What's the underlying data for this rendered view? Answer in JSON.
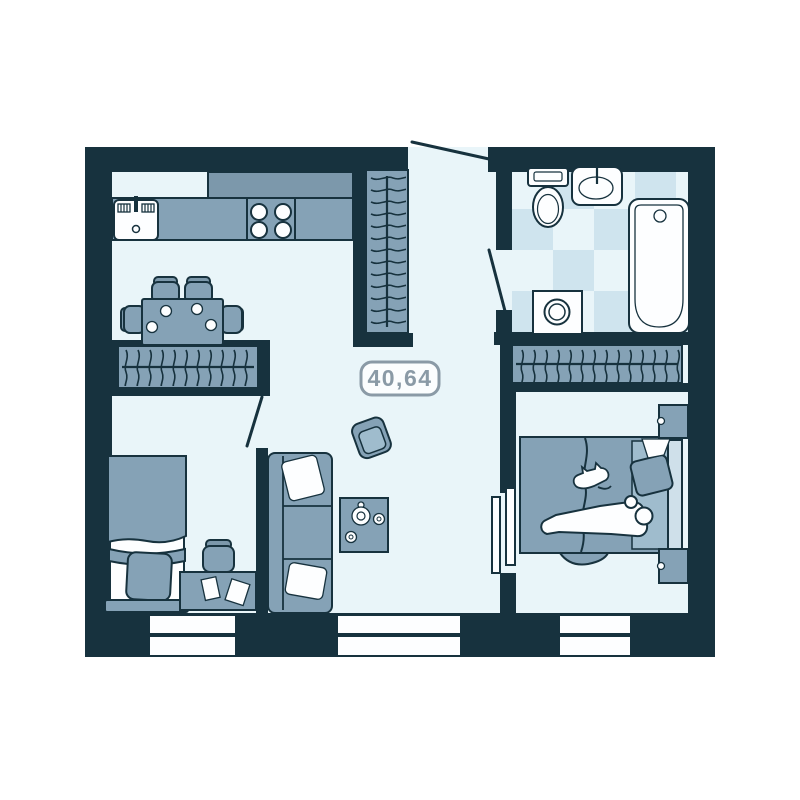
{
  "plan": {
    "area_label": "40,64"
  },
  "colors": {
    "wall": "#17323e",
    "floor": "#e9f5f9",
    "furniture": "#85a2b6",
    "furniture_dark": "#7c98ab",
    "furniture_light": "#cfe0ea",
    "tile": "#cfe4ee",
    "fixture_white": "#fdfeff",
    "label": "#8a9aa6",
    "label_fill": "#fbfdfe",
    "background": "#ffffff"
  },
  "rooms": [
    {
      "name": "kitchen-dining"
    },
    {
      "name": "hallway"
    },
    {
      "name": "bathroom"
    },
    {
      "name": "living-room"
    },
    {
      "name": "bedroom-left"
    },
    {
      "name": "bedroom-right"
    }
  ],
  "furniture_icons": [
    "kitchen-sink-icon",
    "kitchen-counter-icon",
    "stove-burners-icon",
    "dining-table-icon",
    "dining-chair-icon",
    "wardrobe-hangers-icon",
    "toilet-icon",
    "washbasin-icon",
    "bathtub-icon",
    "washing-machine-icon",
    "single-bed-icon",
    "desk-icon",
    "desk-chair-icon",
    "books-icon",
    "sofa-icon",
    "pillow-icon",
    "coffee-table-icon",
    "armchair-icon",
    "double-bed-icon",
    "person-icon",
    "cat-icon",
    "nightstand-icon",
    "window-icon",
    "door-swing-icon",
    "sliding-door-icon"
  ]
}
